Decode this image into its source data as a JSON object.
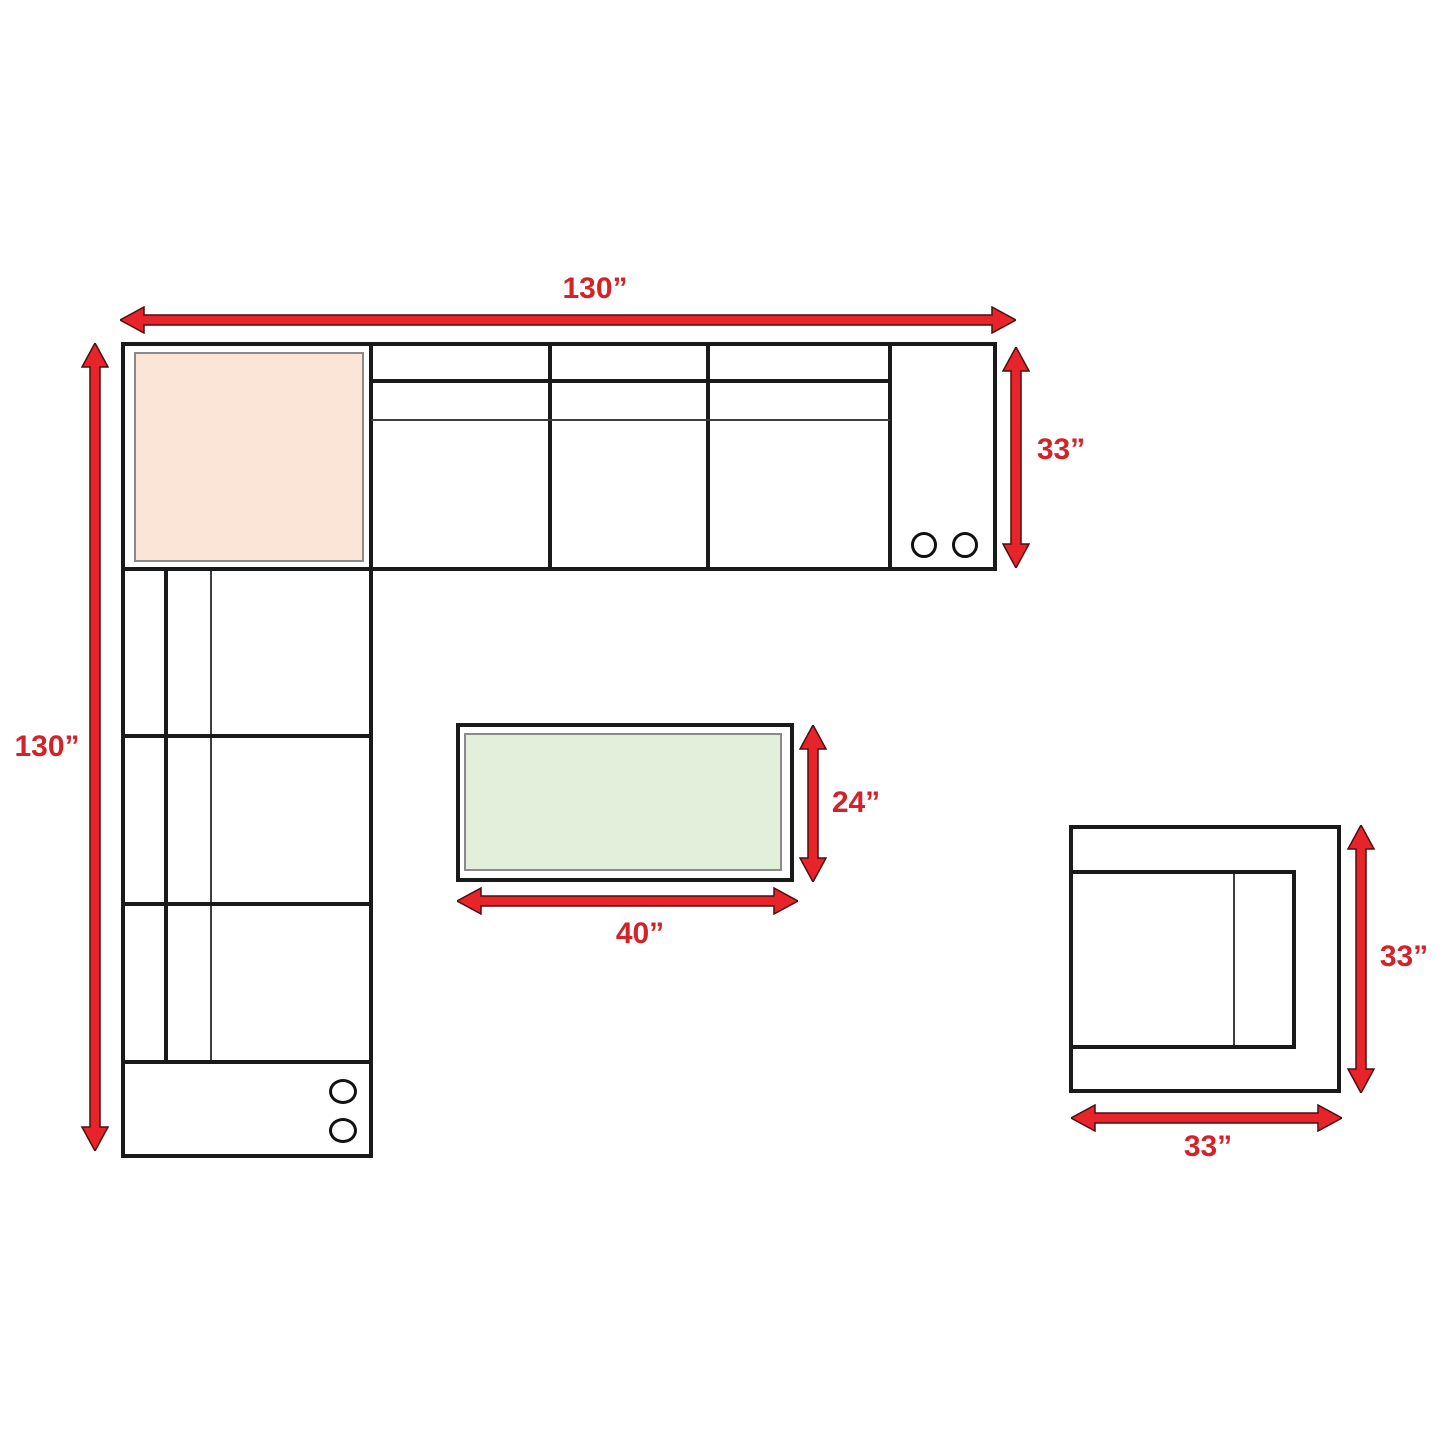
{
  "diagram": {
    "description": "Sectional sofa set dimension plan",
    "labels": {
      "sofa_top_width": "130”",
      "sofa_right_depth": "33”",
      "sofa_left_length": "130”",
      "table_depth": "24”",
      "table_width": "40”",
      "chair_depth": "33”",
      "chair_width": "33”"
    },
    "colors": {
      "arrow_red": "#e8242b",
      "label_red": "#d2232a",
      "outline_black": "#1a1a1a",
      "corner_cushion_fill": "#fbe5d6",
      "table_top_fill": "#e2efda",
      "inner_border_gray": "#8a8a8a"
    },
    "icons": {
      "cupholder": "cupholder-icon",
      "dimension_arrow": "double-arrow-icon"
    }
  }
}
